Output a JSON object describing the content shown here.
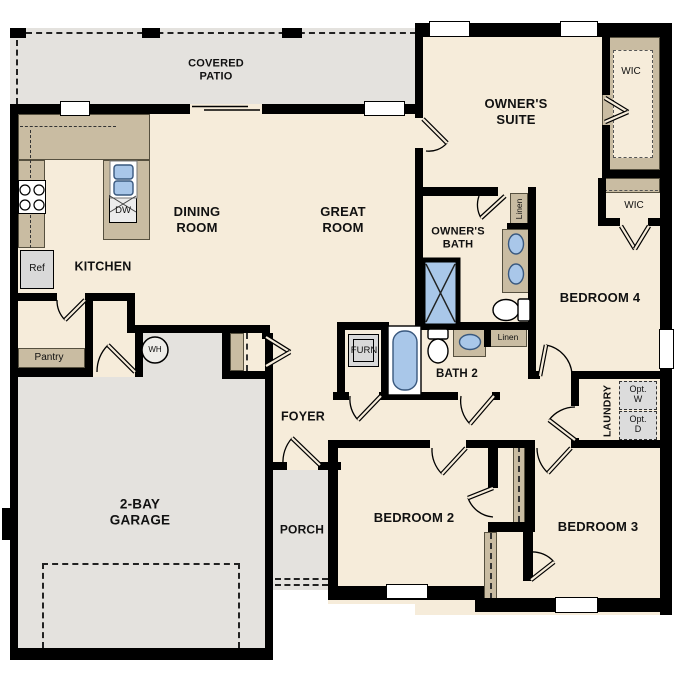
{
  "fp": {
    "labels": {
      "covered_patio": "COVERED\nPATIO",
      "owners_suite": "OWNER'S\nSUITE",
      "wic_owners": "WIC",
      "wic_bed4": "WIC",
      "dining": "DINING\nROOM",
      "great": "GREAT\nROOM",
      "kitchen": "KITCHEN",
      "owners_bath": "OWNER'S\nBATH",
      "bedroom4": "BEDROOM 4",
      "linen_owners": "Linen",
      "linen_hall": "Linen",
      "bath2": "BATH 2",
      "furn": "FURN",
      "ref": "Ref",
      "dw": "DW",
      "wh": "WH",
      "pantry": "Pantry",
      "foyer": "FOYER",
      "porch": "PORCH",
      "garage": "2-BAY\nGARAGE",
      "bedroom2": "BEDROOM 2",
      "bedroom3": "BEDROOM 3",
      "laundry": "LAUNDRY",
      "opt_washer": "Opt.\nW",
      "opt_dryer": "Opt.\nD"
    },
    "colors": {
      "floor": "#f6ecda",
      "outdoor_concrete": "#e4e2de",
      "cabinetry": "#c9bca2",
      "plumbing_fixture_blue": "#a9c7e9",
      "wall": "#000000",
      "appliance_gray": "#d9d9d9"
    }
  }
}
